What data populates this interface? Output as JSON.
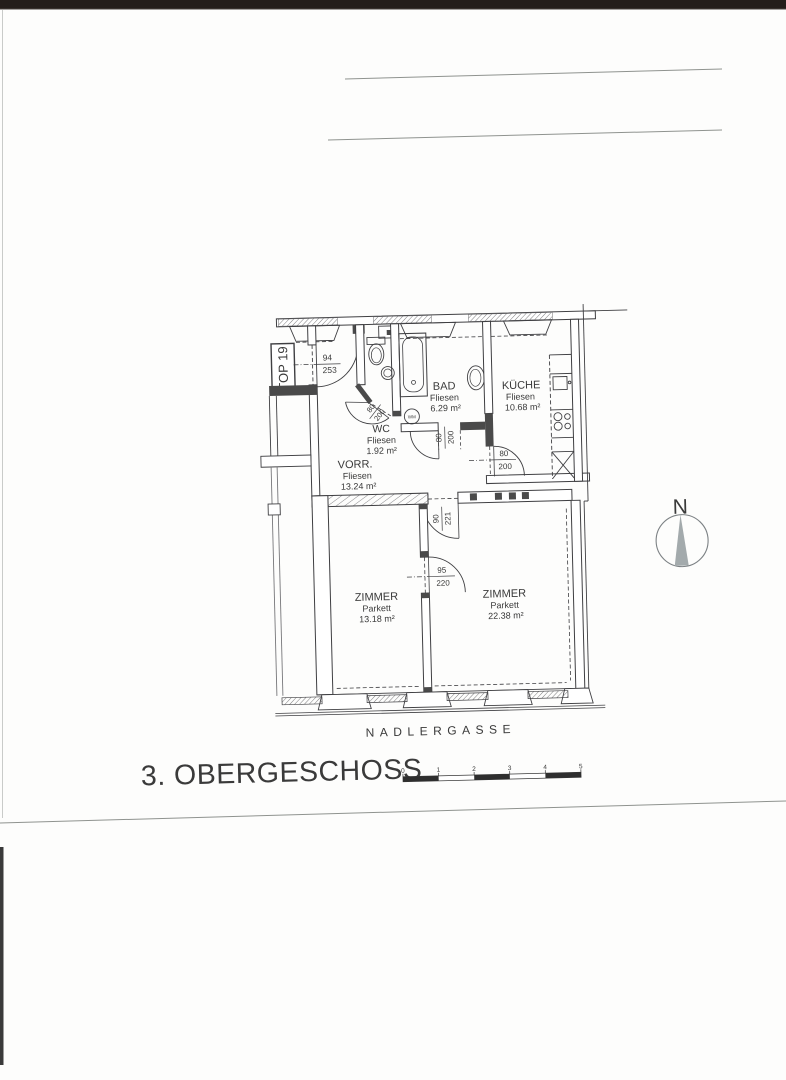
{
  "document": {
    "title": "3. OBERGESCHOSS",
    "street": "NADLERGASSE",
    "unit": "TOP 19",
    "north": "N"
  },
  "rooms": {
    "bad": {
      "name": "BAD",
      "floor": "Fliesen",
      "area": "6.29 m²"
    },
    "kueche": {
      "name": "KÜCHE",
      "floor": "Fliesen",
      "area": "10.68 m²"
    },
    "wc": {
      "name": "WC",
      "floor": "Fliesen",
      "area": "1.92 m²"
    },
    "vorraum": {
      "name": "VORR.",
      "floor": "Fliesen",
      "area": "13.24 m²"
    },
    "zimmer1": {
      "name": "ZIMMER",
      "floor": "Parkett",
      "area": "13.18 m²"
    },
    "zimmer2": {
      "name": "ZIMMER",
      "floor": "Parkett",
      "area": "22.38 m²"
    }
  },
  "doors": {
    "entrance": {
      "w": "94",
      "h": "253"
    },
    "wc": {
      "w": "80",
      "h": "200"
    },
    "bad": {
      "w": "80",
      "h": "200"
    },
    "kueche": {
      "w": "80",
      "h": "200"
    },
    "vorraum_zimmer": {
      "w": "90",
      "h": "221"
    },
    "zimmer_zimmer": {
      "w": "95",
      "h": "220"
    }
  },
  "fixtures": {
    "washing_machine": "WM"
  },
  "scale_bar": {
    "labels": [
      "0",
      "1",
      "2",
      "3",
      "4",
      "5"
    ]
  },
  "colors": {
    "ink": "#3f3f42",
    "text": "#3a3a3a",
    "north_needle": "#a3aaac",
    "scan_band": "#241d1a"
  }
}
